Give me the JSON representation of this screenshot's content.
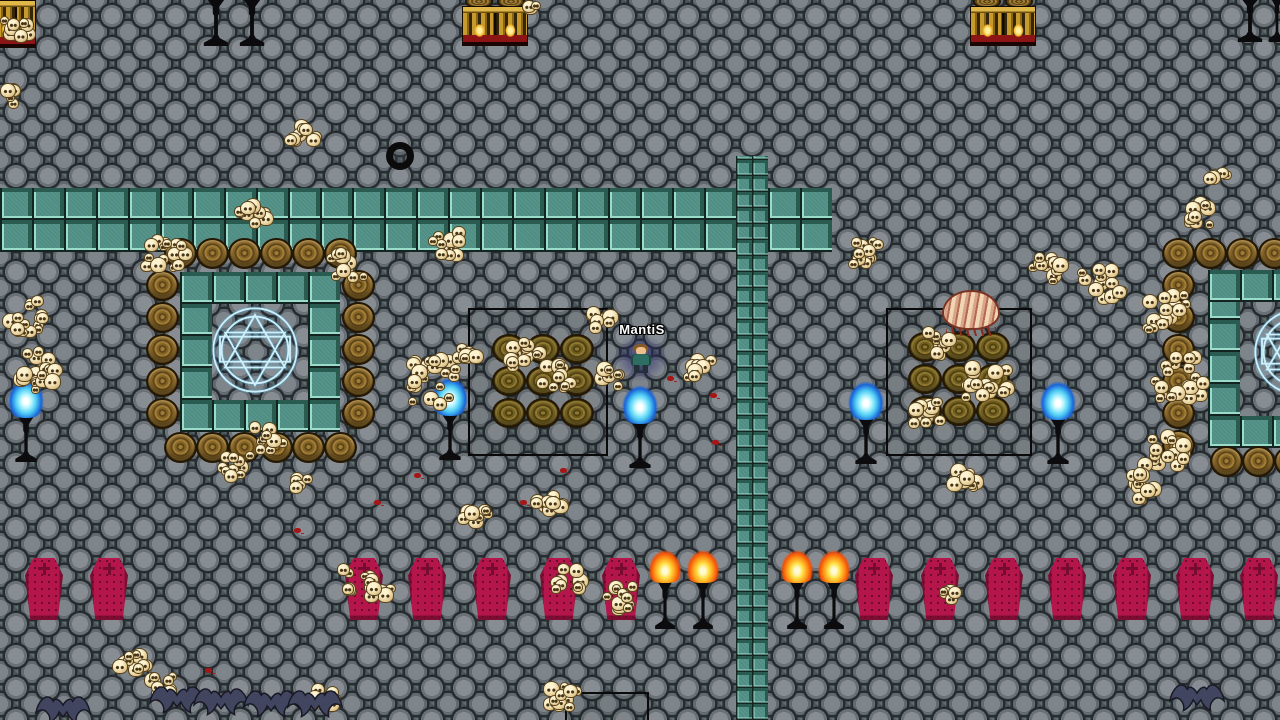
{
  "game": {
    "player": {
      "name": "MantiS",
      "name_color": "#ffffff",
      "x": 628,
      "y": 344,
      "aura": [
        614,
        334,
        54,
        48
      ],
      "name_pos": [
        592,
        322,
        100
      ]
    },
    "colors": {
      "path_teal": "#4f8e84",
      "coffin_red": "#b4164c",
      "flame_orange": "#ff9b18",
      "flame_blue": "#4fcdf4",
      "magic_circle_cyan": "#d6f6ff",
      "skull_bone": "#e9d29c",
      "blood_red": "#a51616"
    },
    "paths": [
      {
        "x": 0,
        "y": 188,
        "w": 832,
        "h": 64,
        "tile": 32
      },
      {
        "x": 736,
        "y": 156,
        "w": 32,
        "h": 564,
        "tile": 16
      },
      {
        "x": 180,
        "y": 272,
        "w": 160,
        "h": 32,
        "tile": 32
      },
      {
        "x": 180,
        "y": 400,
        "w": 160,
        "h": 32,
        "tile": 32
      },
      {
        "x": 180,
        "y": 304,
        "w": 32,
        "h": 96,
        "tile": 32
      },
      {
        "x": 308,
        "y": 304,
        "w": 32,
        "h": 96,
        "tile": 32
      },
      {
        "x": 1208,
        "y": 270,
        "w": 72,
        "h": 32,
        "tile": 32
      },
      {
        "x": 1208,
        "y": 302,
        "w": 32,
        "h": 114,
        "tile": 32
      },
      {
        "x": 1208,
        "y": 416,
        "w": 72,
        "h": 32,
        "tile": 32
      }
    ],
    "magic_circles": [
      {
        "x": 205,
        "y": 300,
        "size": 100
      },
      {
        "x": 1247,
        "y": 302,
        "size": 100
      }
    ],
    "structures": [
      {
        "x": 468,
        "y": 308,
        "w": 140,
        "h": 148,
        "open_bottom": false
      },
      {
        "x": 886,
        "y": 308,
        "w": 146,
        "h": 148,
        "open_bottom": false
      },
      {
        "x": 565,
        "y": 692,
        "w": 84,
        "h": 30,
        "open_bottom": true
      }
    ],
    "barrels": [
      [
        164,
        238
      ],
      [
        196,
        238
      ],
      [
        228,
        238
      ],
      [
        260,
        238
      ],
      [
        292,
        238
      ],
      [
        324,
        238
      ],
      [
        164,
        432
      ],
      [
        196,
        432
      ],
      [
        228,
        432
      ],
      [
        260,
        432
      ],
      [
        292,
        432
      ],
      [
        324,
        432
      ],
      [
        146,
        270
      ],
      [
        146,
        302
      ],
      [
        146,
        334
      ],
      [
        146,
        366
      ],
      [
        146,
        398
      ],
      [
        342,
        270
      ],
      [
        342,
        302
      ],
      [
        342,
        334
      ],
      [
        342,
        366
      ],
      [
        342,
        398
      ],
      [
        1162,
        238
      ],
      [
        1194,
        238
      ],
      [
        1226,
        238
      ],
      [
        1258,
        238
      ],
      [
        1162,
        270
      ],
      [
        1162,
        302
      ],
      [
        1162,
        334
      ],
      [
        1162,
        366
      ],
      [
        1162,
        398
      ],
      [
        1162,
        430
      ],
      [
        1210,
        446
      ],
      [
        1242,
        446
      ],
      [
        1274,
        446
      ]
    ],
    "baskets": [
      [
        492,
        334
      ],
      [
        526,
        334
      ],
      [
        560,
        334
      ],
      [
        492,
        366
      ],
      [
        526,
        366
      ],
      [
        560,
        366
      ],
      [
        492,
        398
      ],
      [
        526,
        398
      ],
      [
        560,
        398
      ],
      [
        908,
        332
      ],
      [
        942,
        332
      ],
      [
        976,
        332
      ],
      [
        908,
        364
      ],
      [
        942,
        364
      ],
      [
        976,
        364
      ],
      [
        908,
        396
      ],
      [
        942,
        396
      ],
      [
        976,
        396
      ]
    ],
    "shrines": [
      {
        "x": 462,
        "y": 6,
        "w": 66,
        "h": 40,
        "lids": true
      },
      {
        "x": 970,
        "y": 6,
        "w": 66,
        "h": 40,
        "lids": true
      },
      {
        "x": -4,
        "y": 0,
        "w": 40,
        "h": 48,
        "lids": false
      }
    ],
    "unlit_stands": [
      [
        200,
        -10,
        32,
        56
      ],
      [
        236,
        -10,
        32,
        56
      ],
      [
        1234,
        -10,
        32,
        52
      ],
      [
        1266,
        -10,
        22,
        52
      ]
    ],
    "coffins": {
      "y": 558,
      "w": 38,
      "h": 62,
      "xs": [
        25,
        90,
        345,
        408,
        473,
        540,
        602,
        855,
        921,
        985,
        1048,
        1113,
        1176,
        1240
      ]
    },
    "torches": [
      [
        646,
        545
      ],
      [
        684,
        545
      ],
      [
        778,
        545
      ],
      [
        815,
        545
      ]
    ],
    "blue_flames": [
      [
        428,
        376
      ],
      [
        618,
        384
      ],
      [
        844,
        380
      ],
      [
        1036,
        380
      ],
      [
        4,
        378
      ]
    ],
    "skull_piles": [
      [
        0,
        16,
        42,
        32
      ],
      [
        0,
        82,
        26,
        30
      ],
      [
        283,
        118,
        42,
        36
      ],
      [
        230,
        198,
        46,
        40
      ],
      [
        138,
        232,
        58,
        48
      ],
      [
        326,
        246,
        46,
        42
      ],
      [
        0,
        292,
        56,
        52
      ],
      [
        8,
        345,
        52,
        46
      ],
      [
        28,
        362,
        42,
        38
      ],
      [
        248,
        418,
        46,
        40
      ],
      [
        212,
        448,
        46,
        38
      ],
      [
        286,
        468,
        36,
        30
      ],
      [
        404,
        352,
        62,
        62
      ],
      [
        446,
        332,
        42,
        36
      ],
      [
        425,
        226,
        46,
        40
      ],
      [
        498,
        336,
        52,
        44
      ],
      [
        533,
        358,
        48,
        42
      ],
      [
        586,
        360,
        42,
        36
      ],
      [
        682,
        352,
        42,
        38
      ],
      [
        585,
        305,
        36,
        32
      ],
      [
        455,
        502,
        42,
        36
      ],
      [
        525,
        490,
        46,
        40
      ],
      [
        336,
        560,
        46,
        40
      ],
      [
        362,
        576,
        36,
        30
      ],
      [
        550,
        562,
        42,
        36
      ],
      [
        595,
        576,
        46,
        46
      ],
      [
        938,
        582,
        32,
        28
      ],
      [
        945,
        460,
        42,
        38
      ],
      [
        902,
        396,
        46,
        40
      ],
      [
        915,
        326,
        46,
        38
      ],
      [
        960,
        360,
        58,
        46
      ],
      [
        845,
        232,
        46,
        40
      ],
      [
        1028,
        248,
        46,
        40
      ],
      [
        1076,
        258,
        58,
        50
      ],
      [
        1182,
        196,
        42,
        36
      ],
      [
        1202,
        166,
        32,
        28
      ],
      [
        1136,
        286,
        58,
        52
      ],
      [
        1150,
        350,
        62,
        58
      ],
      [
        1136,
        426,
        58,
        50
      ],
      [
        1122,
        466,
        48,
        42
      ],
      [
        112,
        636,
        48,
        44
      ],
      [
        140,
        670,
        42,
        38
      ],
      [
        306,
        682,
        38,
        34
      ],
      [
        542,
        678,
        46,
        40
      ],
      [
        518,
        0,
        32,
        16
      ]
    ],
    "blood_spots": [
      [
        667,
        376
      ],
      [
        710,
        393
      ],
      [
        712,
        440
      ],
      [
        294,
        528
      ],
      [
        374,
        500
      ],
      [
        414,
        473
      ],
      [
        520,
        500
      ],
      [
        205,
        668
      ],
      [
        560,
        468
      ]
    ],
    "bats": [
      [
        148,
        684
      ],
      [
        192,
        686
      ],
      [
        242,
        688
      ],
      [
        286,
        688
      ],
      [
        1168,
        682
      ],
      [
        34,
        694
      ]
    ],
    "worm": {
      "x": 942,
      "y": 290,
      "w": 58,
      "h": 46
    },
    "ring_item": {
      "x": 386,
      "y": 142,
      "size": 28
    }
  }
}
